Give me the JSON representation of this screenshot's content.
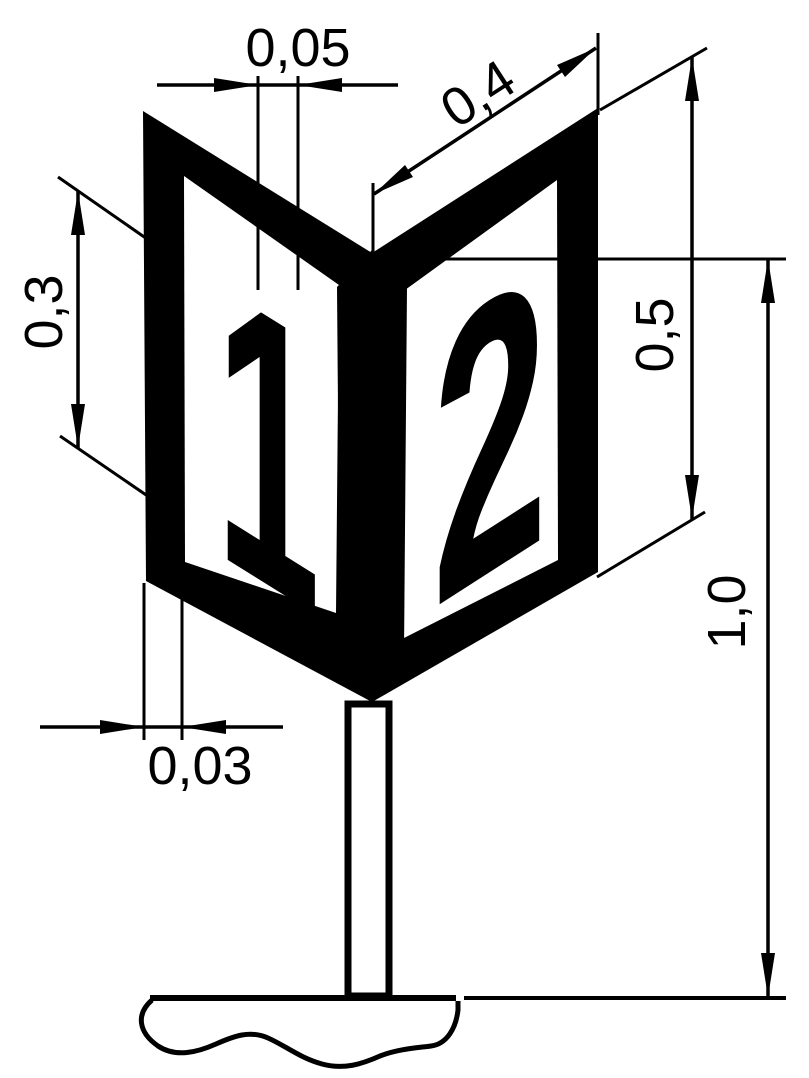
{
  "figure": {
    "type": "technical dimensioned drawing",
    "description": "V-shaped two-faced route number sign (panels 1 and 2) mounted on a post in the ground, with metric dimensions",
    "background_color": "#ffffff",
    "line_color": "#000000"
  },
  "panels": {
    "left_digit": "1",
    "right_digit": "2"
  },
  "dims": {
    "top_gap": {
      "label": "0,05"
    },
    "panel_width": {
      "label": "0,4"
    },
    "digit_height": {
      "label": "0,3"
    },
    "panel_height": {
      "label": "0,5"
    },
    "mount_height": {
      "label": "1,0"
    },
    "frame_width": {
      "label": "0,03"
    }
  }
}
